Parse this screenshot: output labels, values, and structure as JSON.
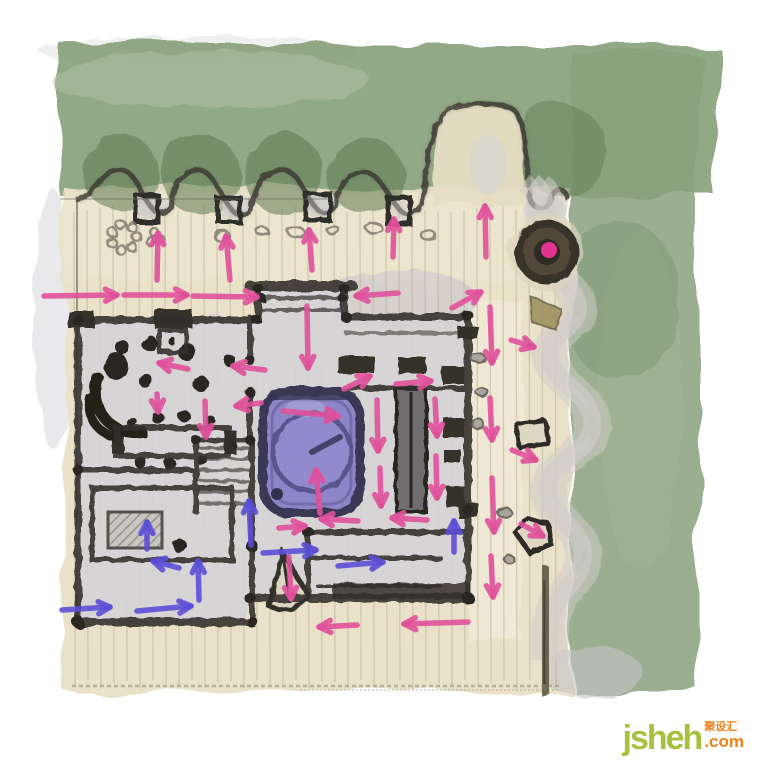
{
  "image": {
    "description": "Hand-drawn watercolor landscape / floor-plan concept sketch with circulation flow arrows",
    "width": 760,
    "height": 760
  },
  "palette": {
    "canopy_green": "#87a078",
    "canopy_dark": "#5e7b53",
    "deck_beige": "#e9e1c7",
    "plan_gray": "#d5d3d6",
    "charcoal": "#332e29",
    "spa_purple": "#8d85c8",
    "spa_border": "#3b3755",
    "flow_primary": "#e0509b",
    "flow_secondary": "#5b4fd6",
    "focal_magenta": "#e23390"
  },
  "watermark": {
    "brand": "jsheh",
    "suffix": ".com",
    "cjk": "聚设汇"
  },
  "features": {
    "focal_point": {
      "cx": 547,
      "cy": 252
    },
    "spa": {
      "x": 263,
      "y": 391,
      "w": 97,
      "h": 122,
      "rx": 26
    }
  },
  "flows": {
    "primary": {
      "color": "#e0509b",
      "arrows": [
        [
          157,
          280,
          158,
          233
        ],
        [
          230,
          280,
          226,
          236
        ],
        [
          312,
          270,
          309,
          230
        ],
        [
          393,
          257,
          394,
          219
        ],
        [
          486,
          257,
          485,
          206
        ],
        [
          44,
          296,
          117,
          295
        ],
        [
          124,
          295,
          187,
          295
        ],
        [
          193,
          296,
          257,
          297
        ],
        [
          307,
          306,
          308,
          368
        ],
        [
          398,
          293,
          356,
          296
        ],
        [
          452,
          308,
          481,
          292
        ],
        [
          188,
          369,
          159,
          363
        ],
        [
          265,
          370,
          233,
          366
        ],
        [
          157,
          394,
          158,
          412
        ],
        [
          205,
          401,
          206,
          437
        ],
        [
          261,
          403,
          236,
          406
        ],
        [
          283,
          411,
          338,
          416
        ],
        [
          320,
          513,
          316,
          470
        ],
        [
          344,
          389,
          370,
          376
        ],
        [
          396,
          384,
          431,
          381
        ],
        [
          377,
          400,
          378,
          451
        ],
        [
          435,
          399,
          437,
          436
        ],
        [
          380,
          468,
          381,
          506
        ],
        [
          436,
          456,
          437,
          498
        ],
        [
          358,
          521,
          321,
          519
        ],
        [
          279,
          528,
          305,
          526
        ],
        [
          427,
          520,
          392,
          518
        ],
        [
          511,
          340,
          534,
          347
        ],
        [
          512,
          450,
          536,
          460
        ],
        [
          521,
          524,
          543,
          536
        ],
        [
          490,
          307,
          492,
          363
        ],
        [
          490,
          398,
          492,
          440
        ],
        [
          492,
          478,
          494,
          532
        ],
        [
          491,
          556,
          493,
          597
        ],
        [
          289,
          557,
          291,
          599
        ],
        [
          357,
          625,
          319,
          627
        ],
        [
          468,
          622,
          404,
          624
        ]
      ]
    },
    "secondary": {
      "color": "#5b4fd6",
      "arrows": [
        [
          62,
          610,
          110,
          607
        ],
        [
          137,
          611,
          191,
          606
        ],
        [
          147,
          549,
          147,
          522
        ],
        [
          179,
          568,
          153,
          561
        ],
        [
          199,
          600,
          198,
          561
        ],
        [
          251,
          545,
          249,
          501
        ],
        [
          263,
          553,
          316,
          550
        ],
        [
          338,
          566,
          383,
          562
        ],
        [
          454,
          552,
          454,
          521
        ]
      ]
    }
  }
}
